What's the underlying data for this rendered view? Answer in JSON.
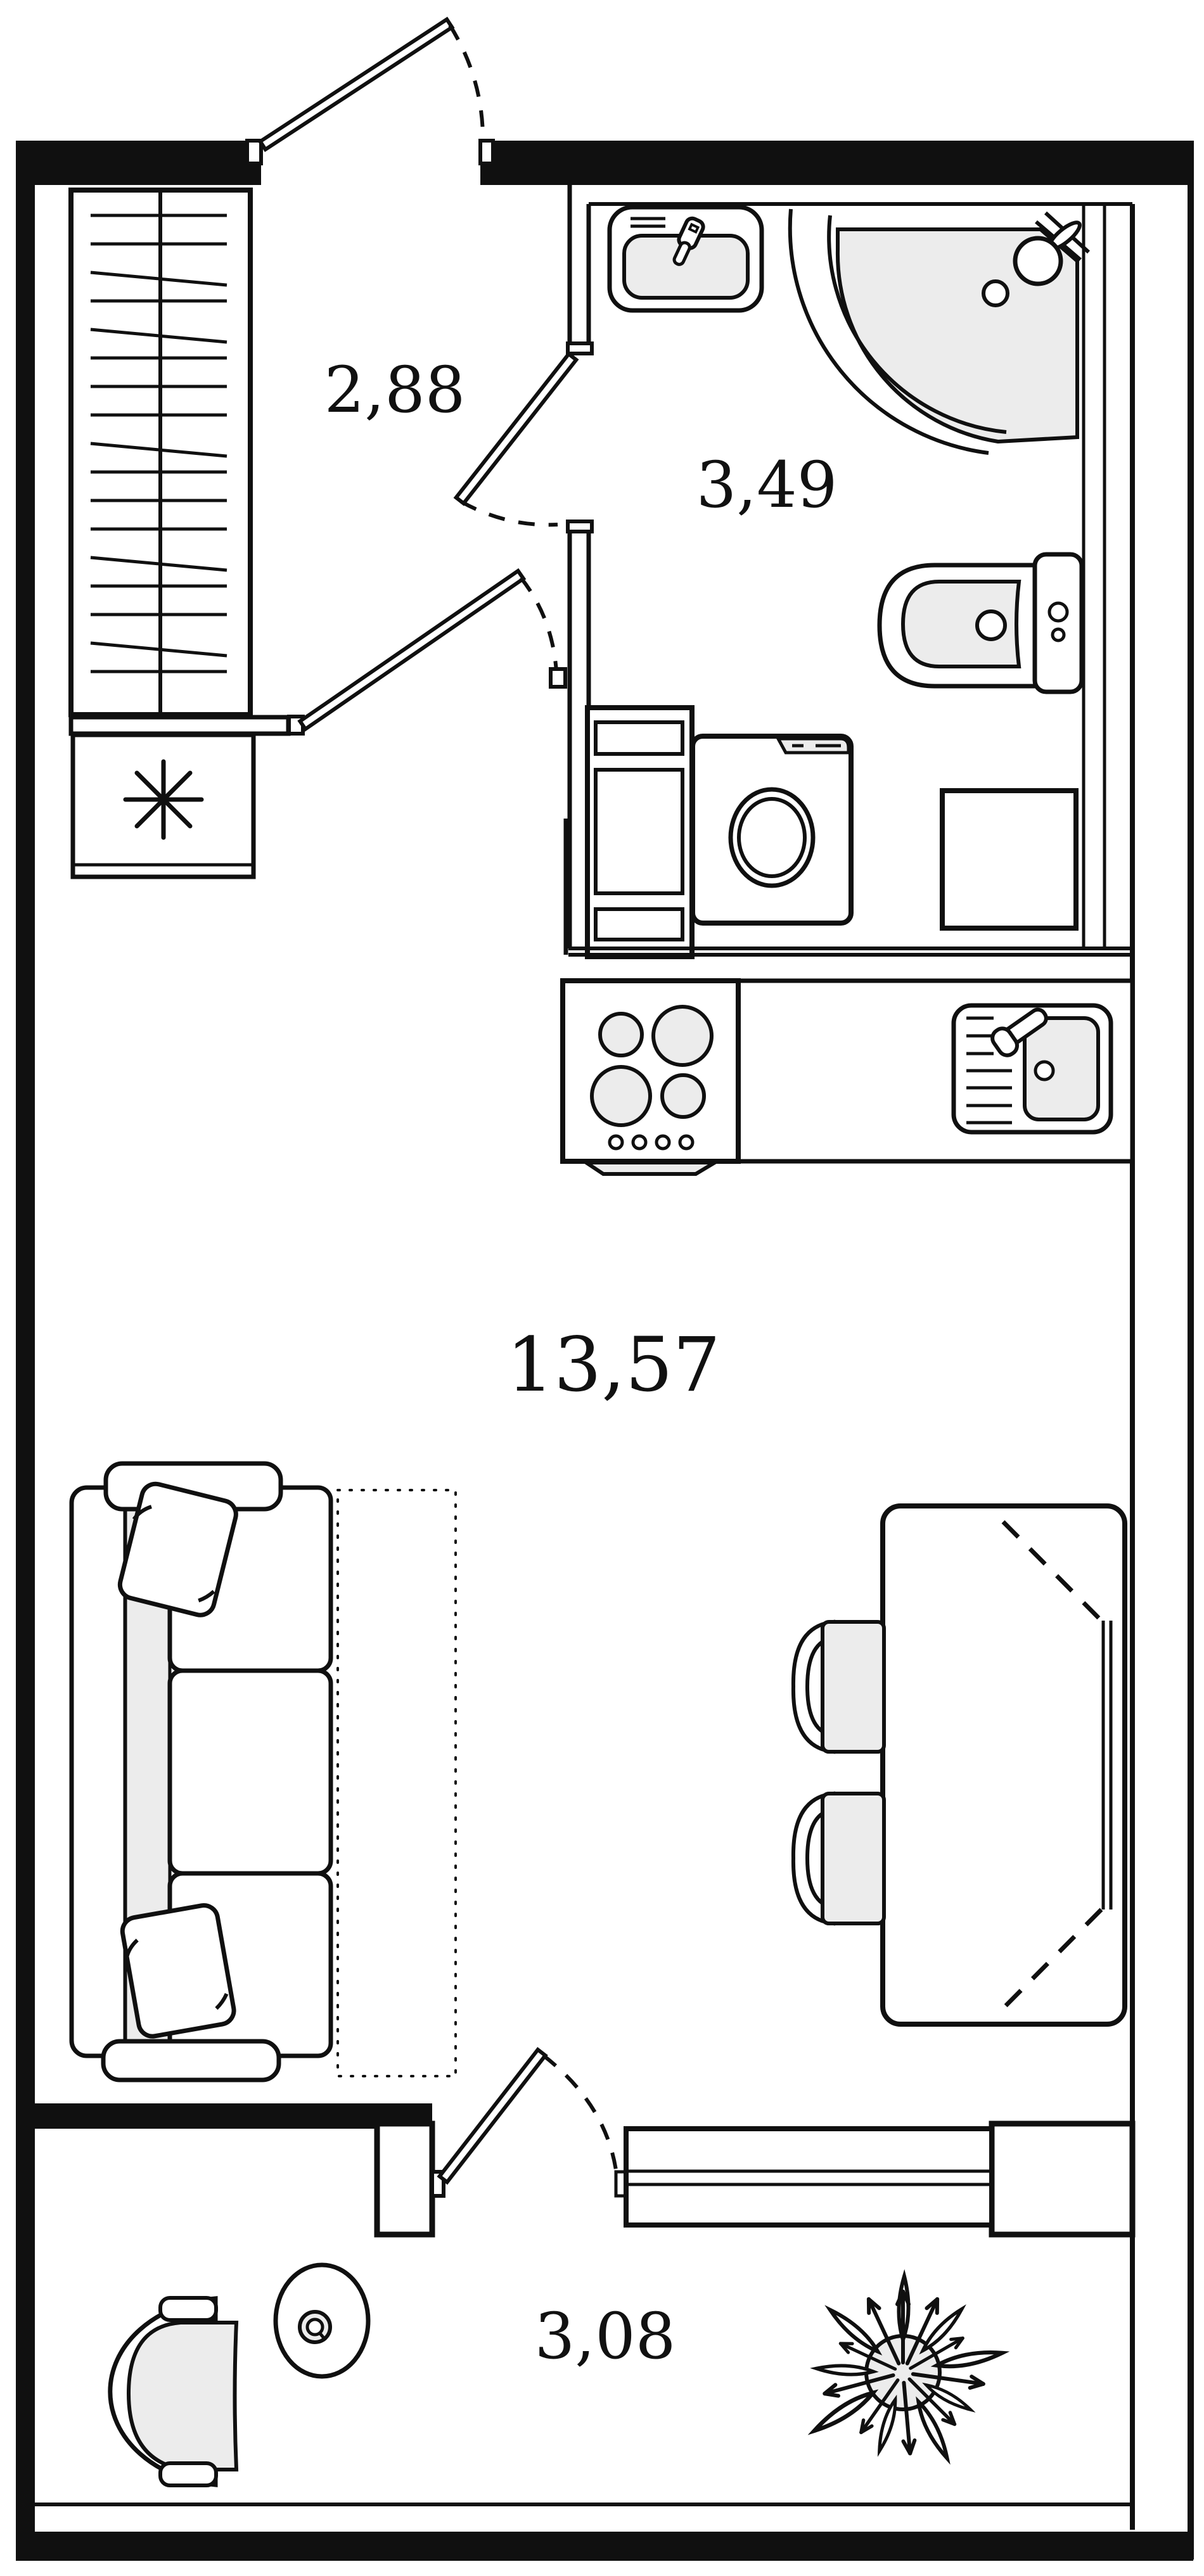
{
  "plan_title": "studio apartment floor plan",
  "colors": {
    "line": "#101010",
    "fixture_fill": "#ececec",
    "background": "#ffffff"
  },
  "rooms": [
    {
      "name": "hallway",
      "area": "2,88"
    },
    {
      "name": "bathroom",
      "area": "3,49"
    },
    {
      "name": "living-kitchen",
      "area": "13,57"
    },
    {
      "name": "balcony",
      "area": "3,08"
    }
  ],
  "symbols": {
    "closet_marker": "✳"
  }
}
